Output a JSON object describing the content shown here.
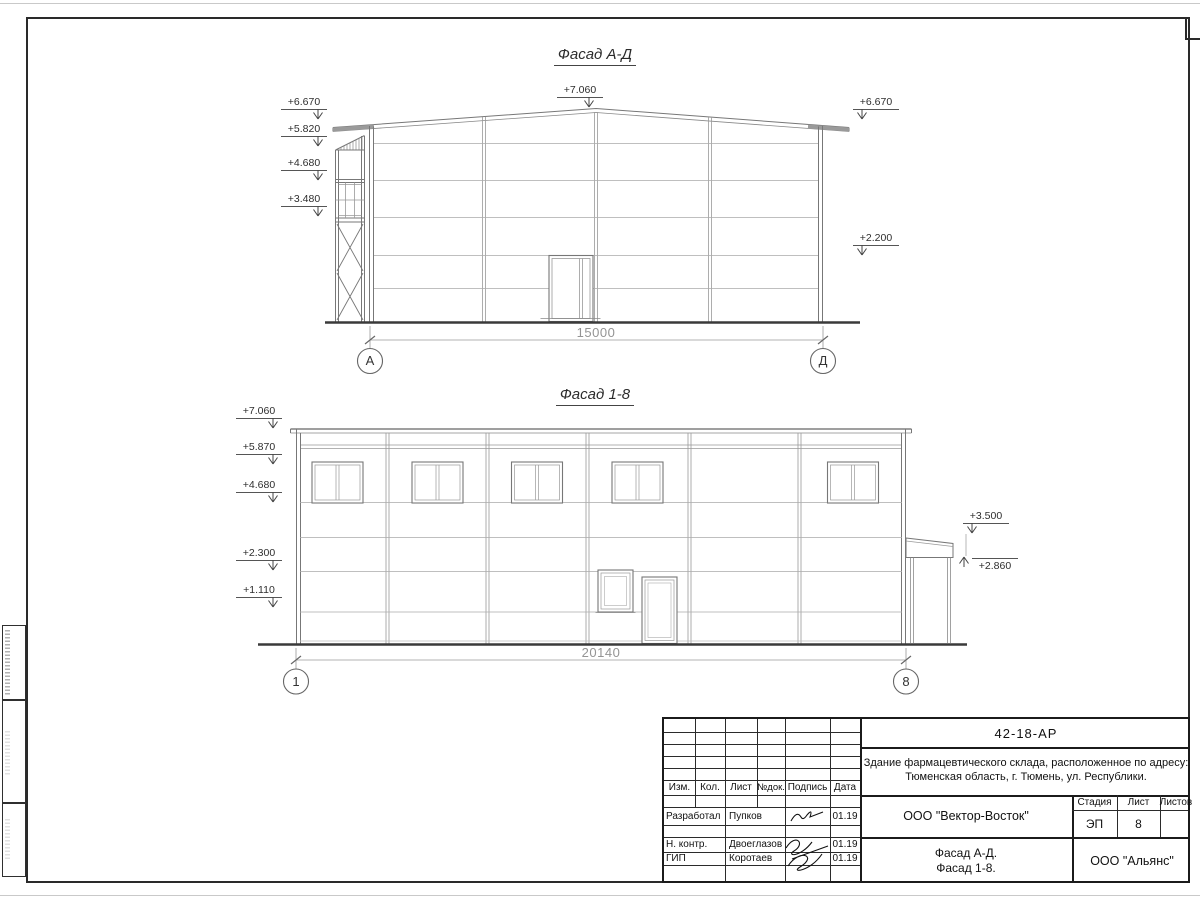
{
  "facade_ad": {
    "title": "Фасад А-Д",
    "mark_top": "+7.060",
    "marks_left": [
      "+6.670",
      "+5.820",
      "+4.680",
      "+3.480"
    ],
    "marks_right": [
      "+6.670",
      "+2.200"
    ],
    "dimension": "15000",
    "axis_left": "А",
    "axis_right": "Д"
  },
  "facade_18": {
    "title": "Фасад 1-8",
    "marks_left": [
      "+7.060",
      "+5.870",
      "+4.680",
      "+2.300",
      "+1.110"
    ],
    "marks_right": [
      "+3.500",
      "+2.860"
    ],
    "dimension": "20140",
    "axis_left": "1",
    "axis_right": "8"
  },
  "title_block": {
    "doc_number": "42-18-АР",
    "project_description_line1": "Здание фармацевтического склада, расположенное по адресу:",
    "project_description_line2": "Тюменская область, г. Тюмень, ул. Республики.",
    "columns": [
      "Изм.",
      "Кол.",
      "Лист",
      "№док.",
      "Подпись",
      "Дата"
    ],
    "staff_rows": [
      {
        "role": "Разработал",
        "name": "Пупков",
        "date": "01.19"
      },
      {
        "role": "Н. контр.",
        "name": "Двоеглазов",
        "date": "01.19"
      },
      {
        "role": "ГИП",
        "name": "Коротаев",
        "date": "01.19"
      }
    ],
    "designer_org": "ООО \"Вектор-Восток\"",
    "stage_label": "Стадия",
    "sheet_label": "Лист",
    "sheets_label": "Листов",
    "stage_value": "ЭП",
    "sheet_number": "8",
    "sheets_value": "",
    "sheet_title_line1": "Фасад А-Д.",
    "sheet_title_line2": "Фасад 1-8.",
    "client_org": "ООО \"Альянс\""
  }
}
